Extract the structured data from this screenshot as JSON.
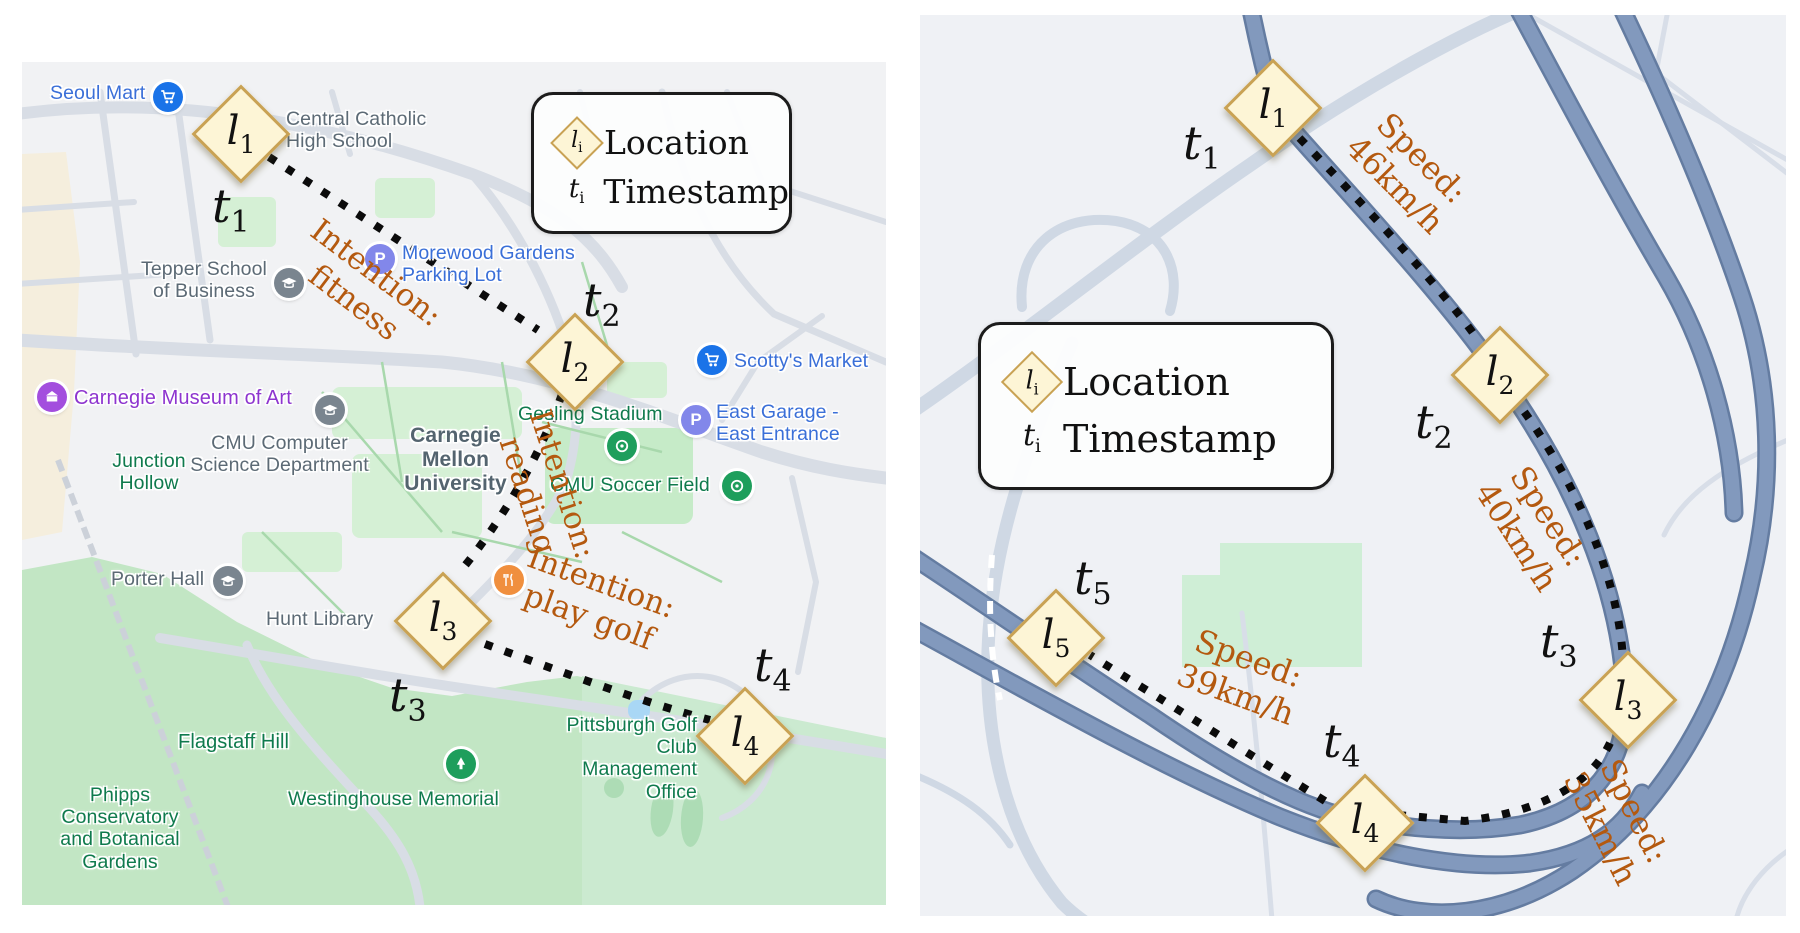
{
  "colors": {
    "marker_fill": "#fdf5d6",
    "marker_border": "#c9a254",
    "annotation_orange": "#b4590f",
    "poi_blue": "#3a6fd8",
    "poi_gray": "#5c6a75",
    "poi_green": "#0f7a4d",
    "poi_purple": "#8e35cf",
    "cmu_slate": "#54646f",
    "park_green": "#c2e6c4",
    "road_gray": "#d8dde5",
    "highway_blue": "#7b93b8",
    "trajectory_black": "#0b0b0b"
  },
  "legend": {
    "location_symbol": "l",
    "location_sub": "i",
    "location_label": "Location",
    "timestamp_symbol": "t",
    "timestamp_sub": "i",
    "timestamp_label": "Timestamp"
  },
  "left_map": {
    "markers": [
      {
        "symbol": "l",
        "sub": "1"
      },
      {
        "symbol": "l",
        "sub": "2"
      },
      {
        "symbol": "l",
        "sub": "3"
      },
      {
        "symbol": "l",
        "sub": "4"
      }
    ],
    "timestamps": [
      {
        "symbol": "t",
        "sub": "1"
      },
      {
        "symbol": "t",
        "sub": "2"
      },
      {
        "symbol": "t",
        "sub": "3"
      },
      {
        "symbol": "t",
        "sub": "4"
      }
    ],
    "annotations": [
      "Intention:\nfitness",
      "Intention:\nreading",
      "Intention:\nplay golf"
    ],
    "poi": [
      "Seoul Mart",
      "Central Catholic\nHigh School",
      "Tepper School\nof Business",
      "Morewood Gardens\nParking Lot",
      "Scotty's Market",
      "Carnegie Museum of Art",
      "CMU Computer\nScience Department",
      "Junction\nHollow",
      "Gesling Stadium",
      "East Garage -\nEast Entrance",
      "Carnegie\nMellon\nUniversity",
      "CMU Soccer Field",
      "Porter Hall",
      "Hunt Library",
      "Flagstaff Hill",
      "Phipps\nConservatory\nand Botanical\nGardens",
      "Westinghouse Memorial",
      "Pittsburgh Golf Club\nManagement Office"
    ]
  },
  "right_map": {
    "markers": [
      {
        "symbol": "l",
        "sub": "1"
      },
      {
        "symbol": "l",
        "sub": "2"
      },
      {
        "symbol": "l",
        "sub": "3"
      },
      {
        "symbol": "l",
        "sub": "4"
      },
      {
        "symbol": "l",
        "sub": "5"
      }
    ],
    "timestamps": [
      {
        "symbol": "t",
        "sub": "1"
      },
      {
        "symbol": "t",
        "sub": "2"
      },
      {
        "symbol": "t",
        "sub": "3"
      },
      {
        "symbol": "t",
        "sub": "4"
      },
      {
        "symbol": "t",
        "sub": "5"
      }
    ],
    "annotations": [
      "Speed:\n46km/h",
      "Speed:\n40km/h",
      "Speed:\n39km/h",
      "Speed:\n35km/h"
    ]
  }
}
